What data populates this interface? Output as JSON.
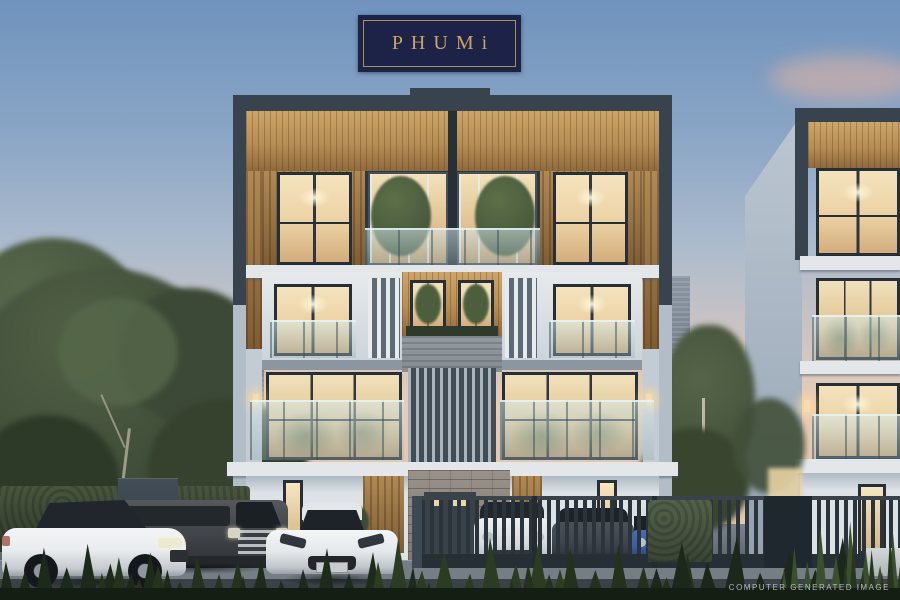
{
  "meta": {
    "description": "Dusk computer-generated architectural rendering of the PHUMi modern townhome project with parked cars, garden fence and city skyline",
    "canvas": {
      "width": 900,
      "height": 600
    }
  },
  "logo": {
    "text": "PHUMi"
  },
  "watermark": {
    "text": "COMPUTER GENERATED IMAGE"
  },
  "palette": {
    "sky_top": "#6f93bd",
    "sky_mid": "#aebccd",
    "sky_horizon": "#e8cdb6",
    "cloud_pink": "#e4b4a2",
    "logo_navy": "#1c2347",
    "logo_gold": "#c9a468",
    "logo_border": "#a98f5e",
    "frame_dark": "#39434d",
    "window_frame": "#262e36",
    "glow_warm": "#f4e3bd",
    "glow_deep": "#d3ad7d",
    "wood_light": "#cda469",
    "wood_dark": "#8f6a3d",
    "wall_white": "#dde2e6",
    "wall_blue": "#b2bdc8",
    "wall_shadow": "#8b96a0",
    "slab_white": "#e3e7ea",
    "stone_light": "#98928a",
    "stone_dark": "#7e7870",
    "fence_dark": "#2b333b",
    "hedge_green": "#3e4a37",
    "tree_green": "#46543e",
    "plant_dark": "#202c1c",
    "plant_light": "#3a4f2d",
    "street_dark": "#3a4147",
    "city_gray": "#8a93a1",
    "car_white": "#eaedef",
    "van_gray": "#45484c",
    "car_dark": "#3e444b",
    "suv_blue": "#3d5d9e",
    "watermark": "#c9ced2"
  },
  "scene": {
    "buildings": [
      "main-townhome-block",
      "side-townhome-block"
    ],
    "vehicles": [
      "white-sedan",
      "dark-van",
      "white-sports-car",
      "white-suv",
      "dark-car",
      "blue-suv"
    ],
    "background": [
      "city-skyline",
      "trees",
      "hedge",
      "slatted-fence",
      "garden-plants"
    ]
  }
}
